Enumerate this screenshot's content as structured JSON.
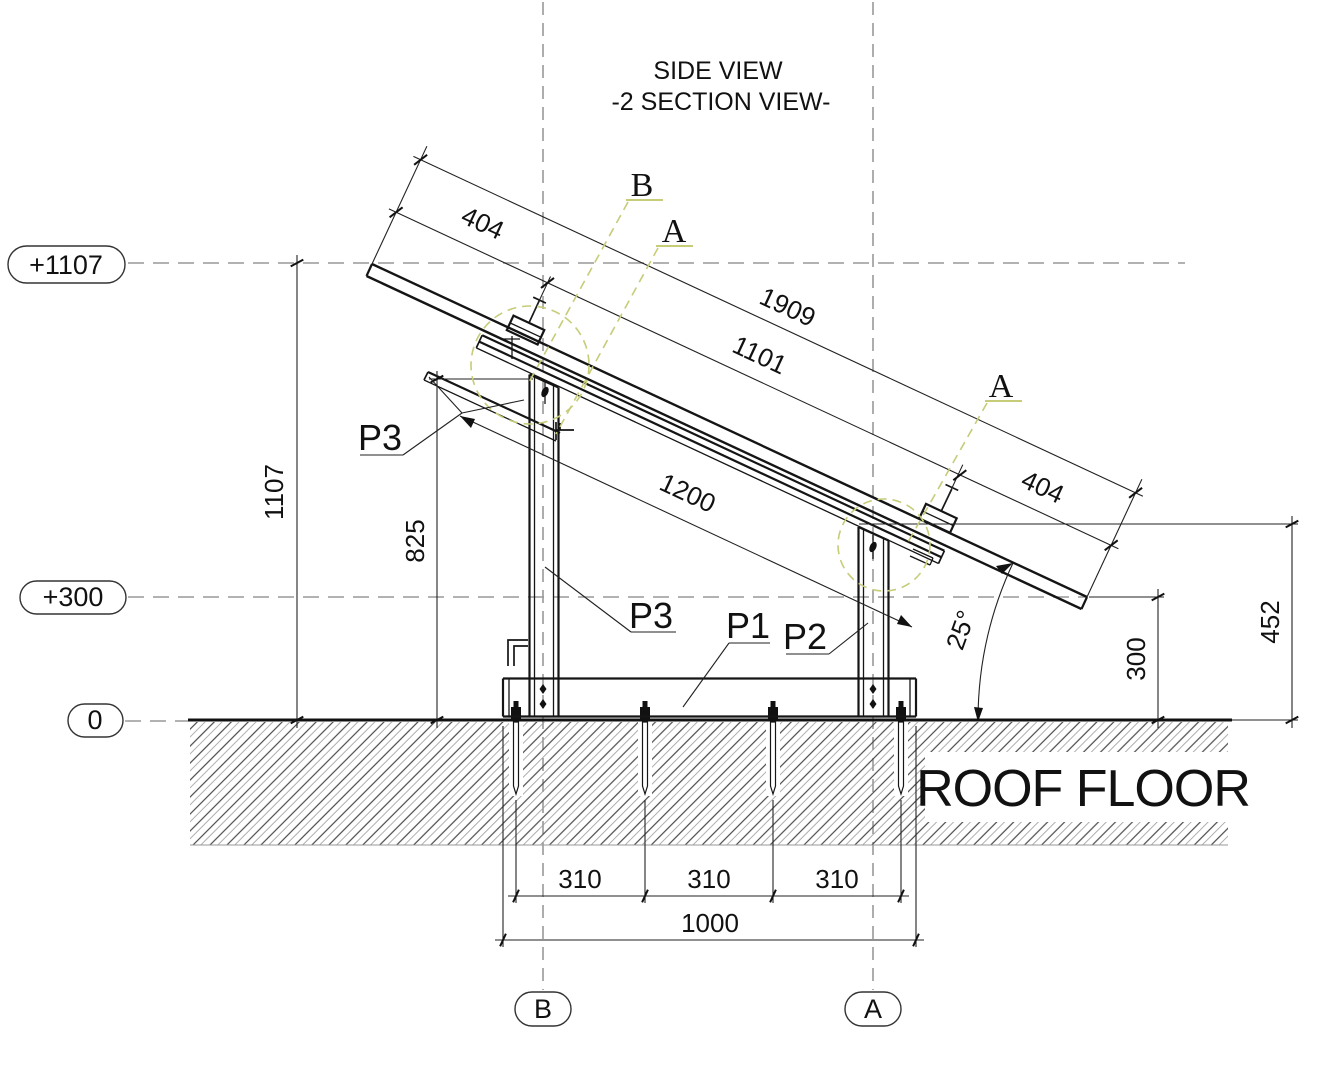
{
  "title": {
    "line1": "SIDE VIEW",
    "line2": "-2 SECTION VIEW-"
  },
  "levels": {
    "top": "+1107",
    "mid": "+300",
    "zero": "0"
  },
  "grid_bubbles": {
    "b": "B",
    "a": "A"
  },
  "section_marks": {
    "b": "B",
    "a_rear": "A",
    "a_front": "A"
  },
  "part_labels": {
    "p3_upper": "P3",
    "p3_lower": "P3",
    "p1": "P1",
    "p2": "P2"
  },
  "dimensions": {
    "overhang_left": "404",
    "total_length": "1909",
    "support_span": "1101",
    "overhang_right": "404",
    "rail_length": "1200",
    "overall_height": "1107",
    "rear_post_height": "825",
    "right_height": "452",
    "front_height": "300",
    "tilt_angle": "25°",
    "anchor_span_1": "310",
    "anchor_span_2": "310",
    "anchor_span_3": "310",
    "base_length": "1000"
  },
  "floor_label": "ROOF FLOOR",
  "colors": {
    "line": "#1c1c1c",
    "dash": "#8f8f8f",
    "olive": "#c6cc78"
  }
}
